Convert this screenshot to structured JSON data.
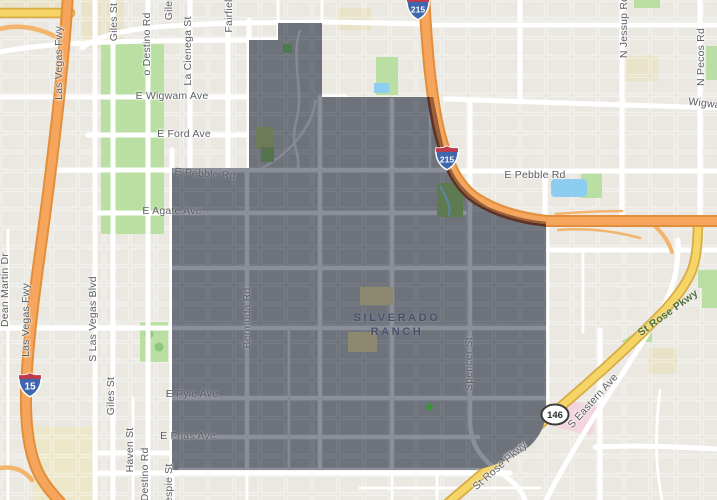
{
  "map": {
    "area_label": {
      "line1": "SILVERADO",
      "line2": "RANCH"
    },
    "street_labels": [
      {
        "text": "Las Vegas Fwy",
        "x": 59,
        "y": 63,
        "r": -90,
        "kind": "street",
        "name": "label-las-vegas-fwy-north"
      },
      {
        "text": "Las Vegas Fwy",
        "x": 26,
        "y": 320,
        "r": -90,
        "kind": "street",
        "name": "label-las-vegas-fwy-south"
      },
      {
        "text": "Dean Martin Dr",
        "x": 5,
        "y": 290,
        "r": -90,
        "kind": "street",
        "name": "label-dean-martin-dr"
      },
      {
        "text": "S Las Vegas Blvd",
        "x": 93,
        "y": 319,
        "r": -90,
        "kind": "street",
        "name": "label-s-las-vegas-blvd"
      },
      {
        "text": "Giles St",
        "x": 114,
        "y": 22,
        "r": -90,
        "kind": "street",
        "name": "label-giles-st-top"
      },
      {
        "text": "Giles St",
        "x": 169,
        "y": 1,
        "r": -90,
        "kind": "street",
        "name": "label-giles-st-top2"
      },
      {
        "text": "Giles St",
        "x": 111,
        "y": 396,
        "r": -90,
        "kind": "street",
        "name": "label-giles-st-bottom"
      },
      {
        "text": "Haven St",
        "x": 130,
        "y": 450,
        "r": -90,
        "kind": "street",
        "name": "label-haven-st"
      },
      {
        "text": "o Destino Rd",
        "x": 147,
        "y": 44,
        "r": -90,
        "kind": "street",
        "name": "label-destino-rd-top"
      },
      {
        "text": "o Destino Rd",
        "x": 145,
        "y": 479,
        "r": -90,
        "kind": "street",
        "name": "label-destino-rd-bottom"
      },
      {
        "text": "La Cienega St",
        "x": 188,
        "y": 51,
        "r": -90,
        "kind": "street",
        "name": "label-la-cienega-st"
      },
      {
        "text": "Fairfield",
        "x": 229,
        "y": 13,
        "r": -90,
        "kind": "street",
        "name": "label-fairfield"
      },
      {
        "text": "Gilespie St",
        "x": 169,
        "y": 490,
        "r": -90,
        "kind": "street",
        "name": "label-gilespie-st"
      },
      {
        "text": "Bermuda Rd",
        "x": 247,
        "y": 318,
        "r": -90,
        "kind": "street-onsel",
        "name": "label-bermuda-rd"
      },
      {
        "text": "Spencer St",
        "x": 469,
        "y": 364,
        "r": -90,
        "kind": "street-onsel",
        "name": "label-spencer-st"
      },
      {
        "text": "N Jessup Rd",
        "x": 624,
        "y": 27,
        "r": -90,
        "kind": "street",
        "name": "label-n-jessup-rd"
      },
      {
        "text": "N Pecos Rd",
        "x": 701,
        "y": 57,
        "r": -90,
        "kind": "street",
        "name": "label-n-pecos-rd"
      },
      {
        "text": "E Wigwam Ave",
        "x": 172,
        "y": 96,
        "r": 0,
        "kind": "street",
        "name": "label-e-wigwam-ave"
      },
      {
        "text": "Wigwam",
        "x": 709,
        "y": 104,
        "r": 7,
        "kind": "street",
        "name": "label-wigwam-right"
      },
      {
        "text": "E Ford Ave",
        "x": 184,
        "y": 134,
        "r": 0,
        "kind": "street",
        "name": "label-e-ford-ave"
      },
      {
        "text": "E Pebble Rd",
        "x": 205,
        "y": 174,
        "r": 4,
        "kind": "street-onsel",
        "name": "label-e-pebble-rd-west"
      },
      {
        "text": "E Pebble Rd",
        "x": 535,
        "y": 175,
        "r": 0,
        "kind": "street",
        "name": "label-e-pebble-rd-east"
      },
      {
        "text": "E Agate Ave",
        "x": 172,
        "y": 211,
        "r": 0,
        "kind": "street-onsel",
        "name": "label-e-agate-ave"
      },
      {
        "text": "E Pyle Ave",
        "x": 192,
        "y": 394,
        "r": 0,
        "kind": "street-onsel",
        "name": "label-e-pyle-ave"
      },
      {
        "text": "E Frias Ave",
        "x": 188,
        "y": 436,
        "r": 0,
        "kind": "street-onsel",
        "name": "label-e-frias-ave"
      },
      {
        "text": "S Eastern Ave",
        "x": 593,
        "y": 401,
        "r": -48,
        "kind": "street",
        "name": "label-s-eastern-ave"
      },
      {
        "text": "St Rose Pkwy",
        "x": 500,
        "y": 466,
        "r": -41,
        "kind": "street",
        "name": "label-st-rose-pkwy-south"
      },
      {
        "text": "St Rose Pkwy",
        "x": 668,
        "y": 313,
        "r": -36,
        "kind": "route-green",
        "name": "label-st-rose-pkwy-green"
      }
    ],
    "shields": [
      {
        "type": "interstate",
        "label": "215",
        "x": 404,
        "y": -5,
        "name": "interstate-215-shield-top"
      },
      {
        "type": "interstate",
        "label": "215",
        "x": 433,
        "y": 145,
        "name": "interstate-215-shield-mid"
      },
      {
        "type": "interstate",
        "label": "15",
        "x": 16,
        "y": 372,
        "name": "interstate-15-shield"
      },
      {
        "type": "state-oval",
        "label": "146",
        "x": 540,
        "y": 403,
        "name": "state-route-146-shield"
      }
    ],
    "colors": {
      "background": "#ebe8e1",
      "road": "#ffffff",
      "freeway": "#f6a55c",
      "freeway_casing": "#e18f3a",
      "ramp": "#f3b46b",
      "highway_yellow": "#f4d565",
      "highway_yellow_casing": "#d7ab45",
      "park": "#b9e0a2",
      "park_tree": "#8cc87e",
      "water": "#8ccdf0",
      "block_khaki": "#e8e2c8",
      "selection_fill": "#6e727b",
      "selection_road": "#8a8f99",
      "selection_mesh": "#7f848e",
      "selection_park": "#5d7a50",
      "selection_school": "#8d8971",
      "freeway_in_selection": "#9a603a",
      "freeway_casing_in_selection": "#5d3123",
      "street_label": "#5b5e63",
      "area_label": "#47516a",
      "route_green_label": "#4f7140",
      "shield_blue": "#3f66ad",
      "shield_red": "#bf3b4b",
      "hospital_pink": "#f3d6dd"
    }
  }
}
